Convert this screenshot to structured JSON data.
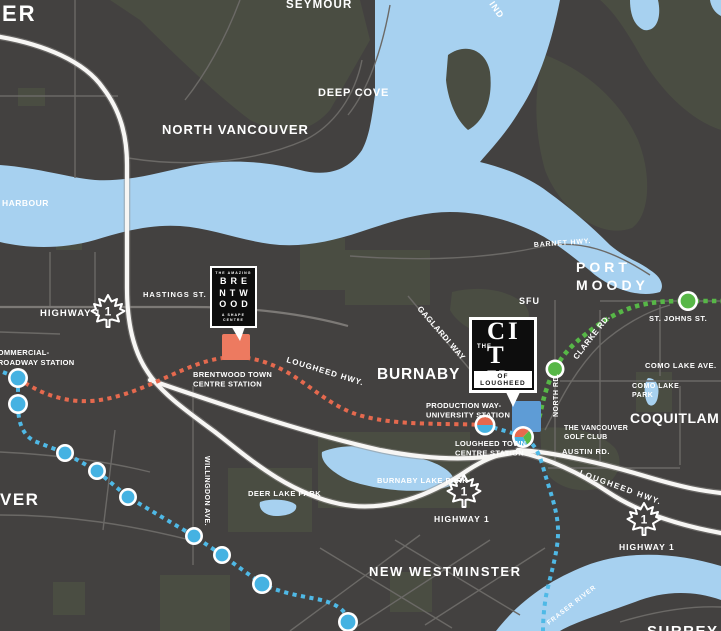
{
  "colors": {
    "background": "#434140",
    "park": "#4A4D42",
    "water": "#A7D1F0",
    "road": "#6B6966",
    "label": "#FFFFFF",
    "orange_line": "#E5694E",
    "blue_line": "#4FB9E6",
    "blue_station": "#45B2E2",
    "green_line": "#57B747",
    "marker_brentwood": "#ED7A60",
    "marker_lougheed": "#5E9CD6",
    "logo_bg": "#0D0D0D"
  },
  "map": {
    "labels": [
      {
        "name": "label-er-partial",
        "text": "ER",
        "x": 2,
        "y": 21,
        "fs": 22,
        "ls": 2
      },
      {
        "name": "label-seymour",
        "text": "SEYMOUR",
        "x": 286,
        "y": 8,
        "fs": 11.5,
        "ls": 1.2
      },
      {
        "name": "label-deep-cove",
        "text": "DEEP COVE",
        "x": 318,
        "y": 96,
        "fs": 11,
        "ls": 0.8
      },
      {
        "name": "label-north-vancouver",
        "text": "NORTH VANCOUVER",
        "x": 162,
        "y": 134,
        "fs": 13,
        "ls": 1
      },
      {
        "name": "label-harbour",
        "text": "HARBOUR",
        "x": 2,
        "y": 206,
        "fs": 8.5,
        "ls": 0.5
      },
      {
        "name": "label-indian-arm-partial",
        "text": "IND",
        "x": 489,
        "y": 4,
        "fs": 9,
        "ls": 1,
        "rot": 55
      },
      {
        "name": "label-highway1-west",
        "text": "HIGHWAY 1",
        "x": 40,
        "y": 316,
        "fs": 9.5,
        "ls": 1
      },
      {
        "name": "label-hastings-st",
        "text": "HASTINGS ST.",
        "x": 143,
        "y": 297,
        "fs": 7.5,
        "ls": 1
      },
      {
        "name": "label-barnet-hwy",
        "text": "BARNET HWY.",
        "x": 534,
        "y": 247,
        "fs": 7,
        "ls": 0.8,
        "rot": -4
      },
      {
        "name": "label-port-moody",
        "lines": [
          "PORT",
          "MOODY"
        ],
        "x": 576,
        "y": 272,
        "fs": 14,
        "ls": 4,
        "lh": 18
      },
      {
        "name": "label-sfu",
        "text": "SFU",
        "x": 519,
        "y": 304,
        "fs": 9,
        "ls": 1
      },
      {
        "name": "label-st-johns-st",
        "text": "ST. JOHNS ST.",
        "x": 649,
        "y": 321,
        "fs": 7.5,
        "ls": 0.5
      },
      {
        "name": "label-clarke-rd",
        "text": "CLARKE RD.",
        "x": 577,
        "y": 360,
        "fs": 8,
        "ls": 0.5,
        "rot": -52
      },
      {
        "name": "label-como-lake-ave",
        "text": "COMO LAKE AVE.",
        "x": 645,
        "y": 368,
        "fs": 7.5,
        "ls": 0.5
      },
      {
        "name": "label-como-lake-park",
        "lines": [
          "COMO LAKE",
          "PARK"
        ],
        "x": 632,
        "y": 388,
        "fs": 7,
        "ls": 0.5,
        "lh": 9
      },
      {
        "name": "label-coquitlam",
        "text": "COQUITLAM",
        "x": 630,
        "y": 423,
        "fs": 14,
        "ls": 0.5
      },
      {
        "name": "label-vancouver-golf-club",
        "lines": [
          "THE VANCOUVER",
          "GOLF CLUB"
        ],
        "x": 564,
        "y": 430,
        "fs": 7,
        "ls": 0.3,
        "lh": 9
      },
      {
        "name": "label-north-rd",
        "text": "NORTH RD.",
        "x": 558,
        "y": 417,
        "fs": 7,
        "ls": 0.5,
        "rot": -90
      },
      {
        "name": "label-austin-rd",
        "text": "AUSTIN RD.",
        "x": 562,
        "y": 454,
        "fs": 7.5,
        "ls": 0.5
      },
      {
        "name": "label-gaglardi-way",
        "text": "GAGLARDI WAY",
        "x": 417,
        "y": 309,
        "fs": 8,
        "ls": 0.5,
        "rot": 49
      },
      {
        "name": "label-burnaby",
        "text": "BURNABY",
        "x": 377,
        "y": 379,
        "fs": 15.5,
        "ls": 0.8
      },
      {
        "name": "label-lougheed-hwy-west",
        "text": "LOUGHEED HWY.",
        "x": 286,
        "y": 362,
        "fs": 8,
        "ls": 1,
        "rot": 17
      },
      {
        "name": "label-commercial-broadway-station",
        "lines": [
          "COMMERCIAL-",
          "BROADWAY STATION"
        ],
        "x": -8,
        "y": 355,
        "fs": 7.5,
        "ls": 0.3,
        "lh": 10
      },
      {
        "name": "label-brentwood-station",
        "lines": [
          "BRENTWOOD TOWN",
          "CENTRE STATION"
        ],
        "x": 193,
        "y": 377,
        "fs": 7.5,
        "ls": 0.3,
        "lh": 9.5
      },
      {
        "name": "label-production-way-station",
        "lines": [
          "PRODUCTION WAY-",
          "UNIVERSITY STATION"
        ],
        "x": 426,
        "y": 408,
        "fs": 7.5,
        "ls": 0.3,
        "lh": 9.5
      },
      {
        "name": "label-lougheed-station",
        "lines": [
          "LOUGHEED TOWN",
          "CENTRE STATION"
        ],
        "x": 455,
        "y": 446,
        "fs": 7.5,
        "ls": 0.3,
        "lh": 9.5
      },
      {
        "name": "label-burnaby-lake-park",
        "text": "BURNABY LAKE PARK",
        "x": 377,
        "y": 483,
        "fs": 7.5,
        "ls": 0.5
      },
      {
        "name": "label-deer-lake-park",
        "text": "DEER LAKE PARK",
        "x": 248,
        "y": 496,
        "fs": 7.5,
        "ls": 0.5
      },
      {
        "name": "label-willingdon-ave",
        "text": "WILLINGDON AVE.",
        "x": 205,
        "y": 456,
        "fs": 7,
        "ls": 0.5,
        "rot": 90
      },
      {
        "name": "label-vancouver-partial",
        "text": "VER",
        "x": 0,
        "y": 505,
        "fs": 17,
        "ls": 1.5
      },
      {
        "name": "label-new-westminster",
        "text": "NEW WESTMINSTER",
        "x": 369,
        "y": 576,
        "fs": 13,
        "ls": 1.5
      },
      {
        "name": "label-highway1-mid",
        "text": "HIGHWAY 1",
        "x": 434,
        "y": 522,
        "fs": 8.5,
        "ls": 1
      },
      {
        "name": "label-lougheed-hwy-east",
        "text": "LOUGHEED HWY.",
        "x": 579,
        "y": 475,
        "fs": 8,
        "ls": 1.5,
        "rot": 20
      },
      {
        "name": "label-highway1-east",
        "text": "HIGHWAY 1",
        "x": 619,
        "y": 550,
        "fs": 8.5,
        "ls": 1
      },
      {
        "name": "label-fraser-river",
        "text": "FRASER RIVER",
        "x": 549,
        "y": 625,
        "fs": 6.5,
        "ls": 1,
        "rot": -38
      },
      {
        "name": "label-surrey-partial",
        "text": "SURREY",
        "x": 647,
        "y": 636,
        "fs": 15,
        "ls": 1.5
      }
    ],
    "badges": [
      {
        "x": 108,
        "y": 311,
        "num": "1"
      },
      {
        "x": 464,
        "y": 491,
        "num": "1"
      },
      {
        "x": 644,
        "y": 519,
        "num": "1"
      }
    ],
    "transit": {
      "lines": [
        {
          "name": "orange-transit-line"
        },
        {
          "name": "blue-transit-line"
        },
        {
          "name": "green-transit-line"
        }
      ],
      "stations": [
        {
          "type": "blue",
          "x": 18,
          "y": 378,
          "r": 10
        },
        {
          "type": "blue",
          "x": 18,
          "y": 404,
          "r": 10
        },
        {
          "type": "blue",
          "x": 65,
          "y": 453,
          "r": 9
        },
        {
          "type": "blue",
          "x": 97,
          "y": 471,
          "r": 9
        },
        {
          "type": "blue",
          "x": 128,
          "y": 497,
          "r": 9
        },
        {
          "type": "blue",
          "x": 194,
          "y": 536,
          "r": 9
        },
        {
          "type": "blue",
          "x": 222,
          "y": 555,
          "r": 9
        },
        {
          "type": "blue",
          "x": 262,
          "y": 584,
          "r": 10
        },
        {
          "type": "blue",
          "x": 348,
          "y": 622,
          "r": 10
        },
        {
          "type": "green",
          "x": 555,
          "y": 369,
          "r": 9.5
        },
        {
          "type": "green",
          "x": 688,
          "y": 301,
          "r": 10
        },
        {
          "type": "duo",
          "x": 485,
          "y": 425,
          "r": 10.5
        },
        {
          "type": "tri",
          "x": 523,
          "y": 437,
          "r": 11
        }
      ]
    }
  },
  "logos": {
    "brentwood": {
      "tagline_top": "THE AMAZING",
      "rows": [
        "BRE",
        "NTW",
        "OOD"
      ],
      "tagline_bottom": "A SHAPE CENTRE"
    },
    "lougheed": {
      "the": "THE",
      "name": "CITY",
      "sub": "OF LOUGHEED"
    }
  }
}
